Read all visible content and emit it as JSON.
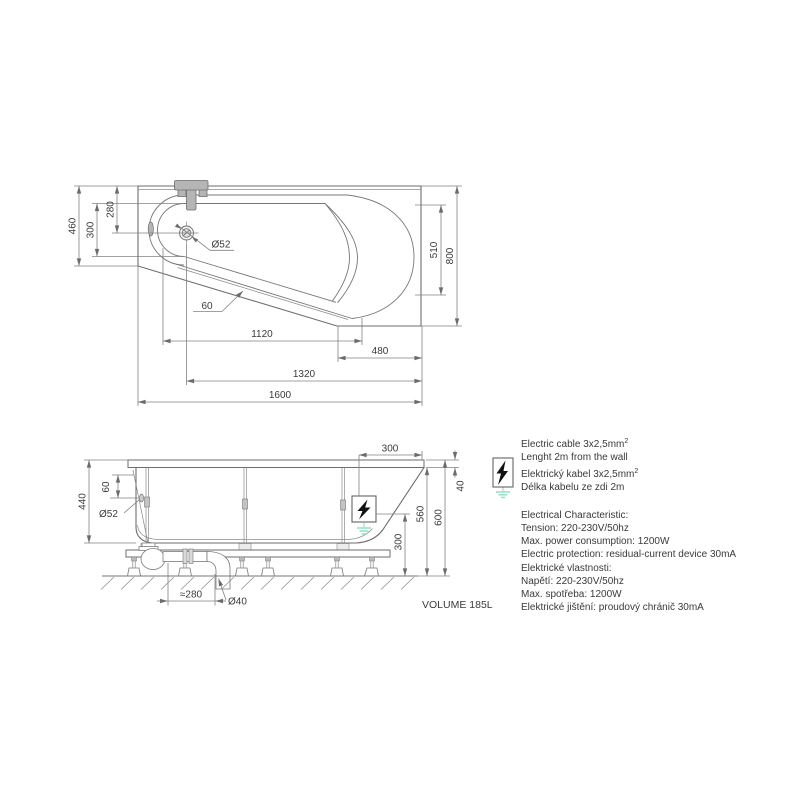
{
  "colors": {
    "tub_fill": "#e9e9e9",
    "line": "#6e6e6e",
    "dim": "#828282",
    "text": "#3a3a3a",
    "fixture": "#b5b5b5",
    "ground_symbol": "#8fdcc0",
    "bolt": "#111111"
  },
  "top_view": {
    "d460": "460",
    "d300": "300",
    "d280": "280",
    "drain": "Ø52",
    "d510": "510",
    "d800": "800",
    "rim": "60",
    "d1120": "1120",
    "d480": "480",
    "d1320": "1320",
    "d1600": "1600"
  },
  "side_view": {
    "d440": "440",
    "d60": "60",
    "overflow": "Ø52",
    "d300_top": "300",
    "d40": "40",
    "d560": "560",
    "d600": "600",
    "d300_out": "300",
    "d280": "≈280",
    "pipe": "Ø40",
    "volume": "VOLUME 185L"
  },
  "notes": {
    "en_cable": "Electric cable 3x2,5mm",
    "en_cable_sup": "2",
    "en_length": "Lenght 2m from the wall",
    "cz_cable": "Elektrický kabel 3x2,5mm",
    "cz_cable_sup": "2",
    "cz_length": "Délka kabelu ze zdi 2m",
    "en_char_title": "Electrical Characteristic:",
    "en_tension": "Tension: 220-230V/50hz",
    "en_power": "Max. power consumption: 1200W",
    "en_protection": "Electric protection: residual-current device 30mA",
    "cz_char_title": "Elektrické vlastnosti:",
    "cz_tension": "Napětí: 220-230V/50hz",
    "cz_power": "Max. spotřeba: 1200W",
    "cz_protection": "Elektrické jištění: proudový chránič 30mA"
  }
}
